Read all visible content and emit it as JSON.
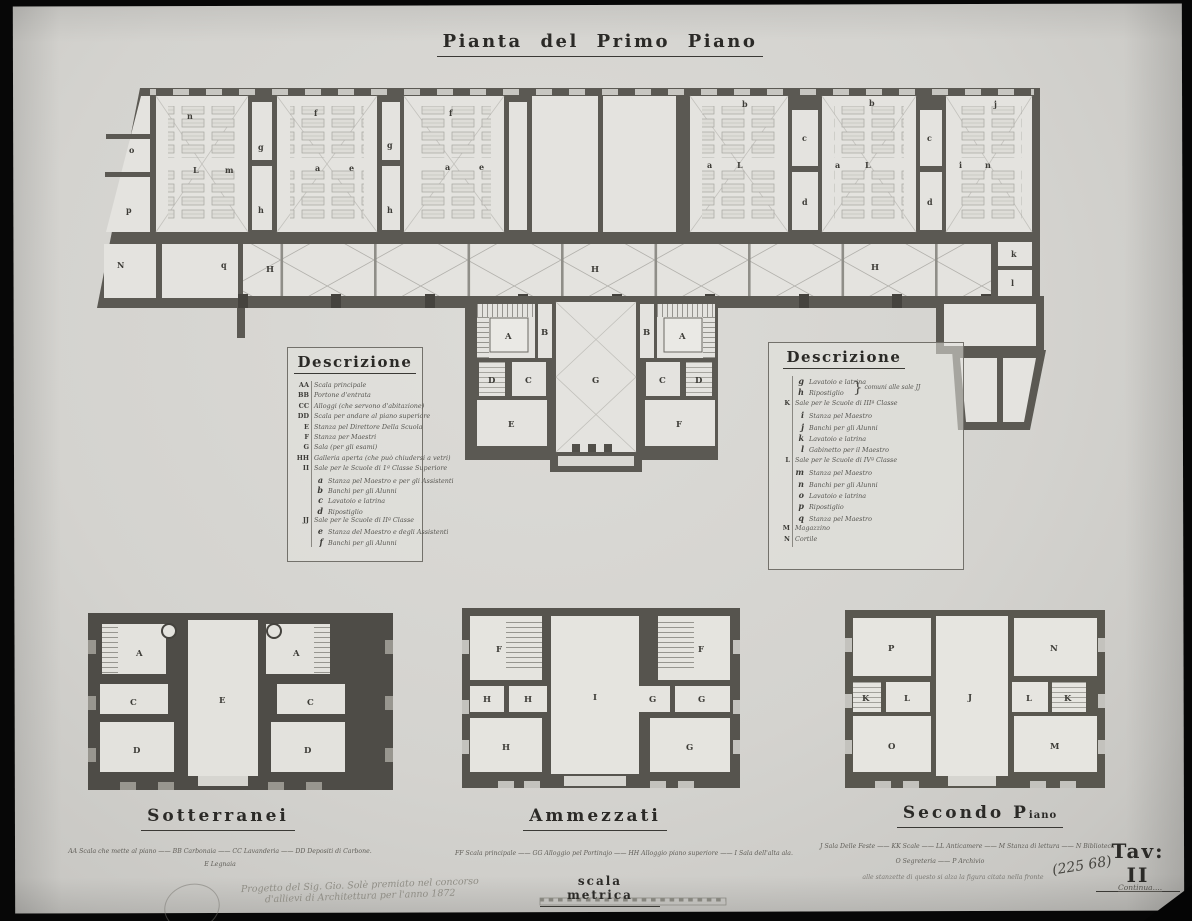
{
  "page": {
    "title": "Pianta  del  Primo  Piano",
    "plate": "Tav: II",
    "archive_number": "(225 68)",
    "continua_note": "Continua....",
    "scale_label": "scala metrica",
    "pencil_note_line1": "Progetto del Sig. Gio. Solè premiato nel concorso",
    "pencil_note_line2": "d'allievi di Architettura per l'anno 1872"
  },
  "colors": {
    "paper": "#d4d3cf",
    "walls": "#5b5953",
    "basement_walls": "#4e4c47",
    "floor": "#e4e3df",
    "photo_border": "#070707"
  },
  "legend_left": {
    "title": "Descrizione",
    "entries": [
      {
        "k": "AA",
        "t": "Scala principale"
      },
      {
        "k": "BB",
        "t": "Portone d'entrata"
      },
      {
        "k": "CC",
        "t": "Alloggi (che servono d'abitazione)"
      },
      {
        "k": "DD",
        "t": "Scala per andare al piano superiore"
      },
      {
        "k": "E",
        "t": "Stanza pel Direttore Della Scuola"
      },
      {
        "k": "F",
        "t": "Stanza per Maestri"
      },
      {
        "k": "G",
        "t": "Sala (per gli esami)"
      },
      {
        "k": "HH",
        "t": "Galleria aperta (che può chiudersi a vetri)"
      },
      {
        "k": "II",
        "t": "Sale per le Scuole di 1ª Classe Superiore"
      },
      {
        "k": "a",
        "t": "Stanza pel Maestro e per gli Assistenti"
      },
      {
        "k": "b",
        "t": "Banchi per gli Alunni"
      },
      {
        "k": "c",
        "t": "Lavatoio e latrina"
      },
      {
        "k": "d",
        "t": "Ripostiglio"
      },
      {
        "k": "JJ",
        "t": "Sale per le Scuole di IIª Classe"
      },
      {
        "k": "e",
        "t": "Stanza del Maestro e degli Assistenti"
      },
      {
        "k": "f",
        "t": "Banchi per gli Alunni"
      }
    ]
  },
  "legend_right": {
    "title": "Descrizione",
    "brace_note": "comuni alle sale JJ",
    "entries": [
      {
        "k": "g",
        "t": "Lavatoio e latrina"
      },
      {
        "k": "h",
        "t": "Ripostiglio"
      },
      {
        "k": "K",
        "t": "Sale per le Scuole di IIIª Classe"
      },
      {
        "k": "i",
        "t": "Stanza pel Maestro"
      },
      {
        "k": "j",
        "t": "Banchi per gli Alunni"
      },
      {
        "k": "k",
        "t": "Lavatoio e latrina"
      },
      {
        "k": "l",
        "t": "Gabinetto per il Maestro"
      },
      {
        "k": "L",
        "t": "Sale per le Scuole di IVª Classe"
      },
      {
        "k": "m",
        "t": "Stanza pel Maestro"
      },
      {
        "k": "n",
        "t": "Banchi per gli Alunni"
      },
      {
        "k": "o",
        "t": "Lavatoio e latrina"
      },
      {
        "k": "p",
        "t": "Ripostiglio"
      },
      {
        "k": "q",
        "t": "Stanza pel Maestro"
      },
      {
        "k": "M",
        "t": "Magazzino"
      },
      {
        "k": "N",
        "t": "Cortile"
      }
    ]
  },
  "main_plan": {
    "labels": [
      {
        "t": "n"
      },
      {
        "t": "f"
      },
      {
        "t": "f"
      },
      {
        "t": "o"
      },
      {
        "t": "g"
      },
      {
        "t": "g"
      },
      {
        "t": "L"
      },
      {
        "t": "m"
      },
      {
        "t": "a"
      },
      {
        "t": "e"
      },
      {
        "t": "a"
      },
      {
        "t": "e"
      },
      {
        "t": "p"
      },
      {
        "t": "h"
      },
      {
        "t": "h"
      },
      {
        "t": "N"
      },
      {
        "t": "q"
      },
      {
        "t": "H"
      },
      {
        "t": "H"
      },
      {
        "t": "H"
      },
      {
        "t": "b"
      },
      {
        "t": "b"
      },
      {
        "t": "j"
      },
      {
        "t": "a"
      },
      {
        "t": "L"
      },
      {
        "t": "c"
      },
      {
        "t": "d"
      },
      {
        "t": "a"
      },
      {
        "t": "L"
      },
      {
        "t": "c"
      },
      {
        "t": "d"
      },
      {
        "t": "i"
      },
      {
        "t": "n"
      },
      {
        "t": "k"
      },
      {
        "t": "l"
      },
      {
        "t": "A"
      },
      {
        "t": "B"
      },
      {
        "t": "B"
      },
      {
        "t": "A"
      },
      {
        "t": "D"
      },
      {
        "t": "C"
      },
      {
        "t": "G"
      },
      {
        "t": "C"
      },
      {
        "t": "D"
      },
      {
        "t": "E"
      },
      {
        "t": "F"
      }
    ]
  },
  "sott": {
    "title": "Sotterranei",
    "line1": "AA Scala che mette al piano —— BB Carbonaia —— CC Lavanderia —— DD Depositi di Carbone.",
    "line2": "E Legnaia",
    "labels": [
      {
        "t": "A"
      },
      {
        "t": "A"
      },
      {
        "t": "C"
      },
      {
        "t": "C"
      },
      {
        "t": "E"
      },
      {
        "t": "D"
      },
      {
        "t": "D"
      }
    ]
  },
  "amm": {
    "title": "Ammezzati",
    "line1": "FF Scala principale —— GG Alloggio pel Portinajo —— HH Alloggio piano superiore —— I Sala dell'alta ala.",
    "labels": [
      {
        "t": "F"
      },
      {
        "t": "F"
      },
      {
        "t": "H"
      },
      {
        "t": "H"
      },
      {
        "t": "I"
      },
      {
        "t": "G"
      },
      {
        "t": "G"
      },
      {
        "t": "H"
      },
      {
        "t": "G"
      }
    ]
  },
  "sec": {
    "title_main": "Secondo  P",
    "title_small": "iano",
    "line1": "J Sala Delle Feste —— KK Scale —— LL Anticamere —— M Stanza di lettura —— N Biblioteca",
    "line2": "O Segreteria —— P Archivio",
    "note": "alle stanzette di questo si alza la figura citata nella fronte",
    "labels": [
      {
        "t": "P"
      },
      {
        "t": "N"
      },
      {
        "t": "K"
      },
      {
        "t": "L"
      },
      {
        "t": "J"
      },
      {
        "t": "L"
      },
      {
        "t": "K"
      },
      {
        "t": "O"
      },
      {
        "t": "M"
      }
    ]
  }
}
